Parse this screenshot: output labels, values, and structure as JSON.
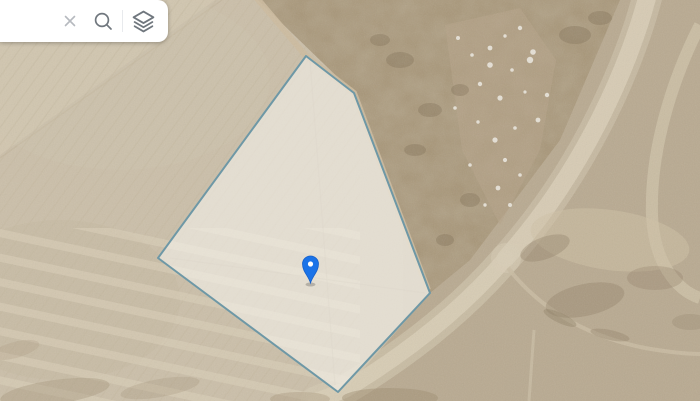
{
  "app": {
    "name": "map-satellite-view"
  },
  "toolbar": {
    "search": {
      "value": "",
      "placeholder": ""
    },
    "icons": {
      "close": "x-cross",
      "search": "magnifier",
      "layers": "stacked-sheets"
    }
  },
  "map": {
    "type": "satellite-imagery",
    "parcel": {
      "points": "306,56 354,93 430,293 338,392 158,258",
      "stroke_color": "#6e98a6",
      "fill_color": "rgba(248,246,240,0.55)",
      "stroke_width": "2"
    },
    "marker": {
      "transform": "translate(310.5,283)",
      "color": "#1a73e8",
      "border_color": "#1660c9",
      "dot_color": "#ffffff"
    }
  },
  "colors": {
    "toolbar_bg": "#ffffff",
    "icon_muted": "#b6babf",
    "icon_default": "#70777e",
    "field_beige": "#cbbfa9",
    "terrain_tan": "#b9aa91",
    "scrub_brown": "#a49173",
    "rock_strip": "#b6a489",
    "road_light": "#d8cdb6"
  }
}
